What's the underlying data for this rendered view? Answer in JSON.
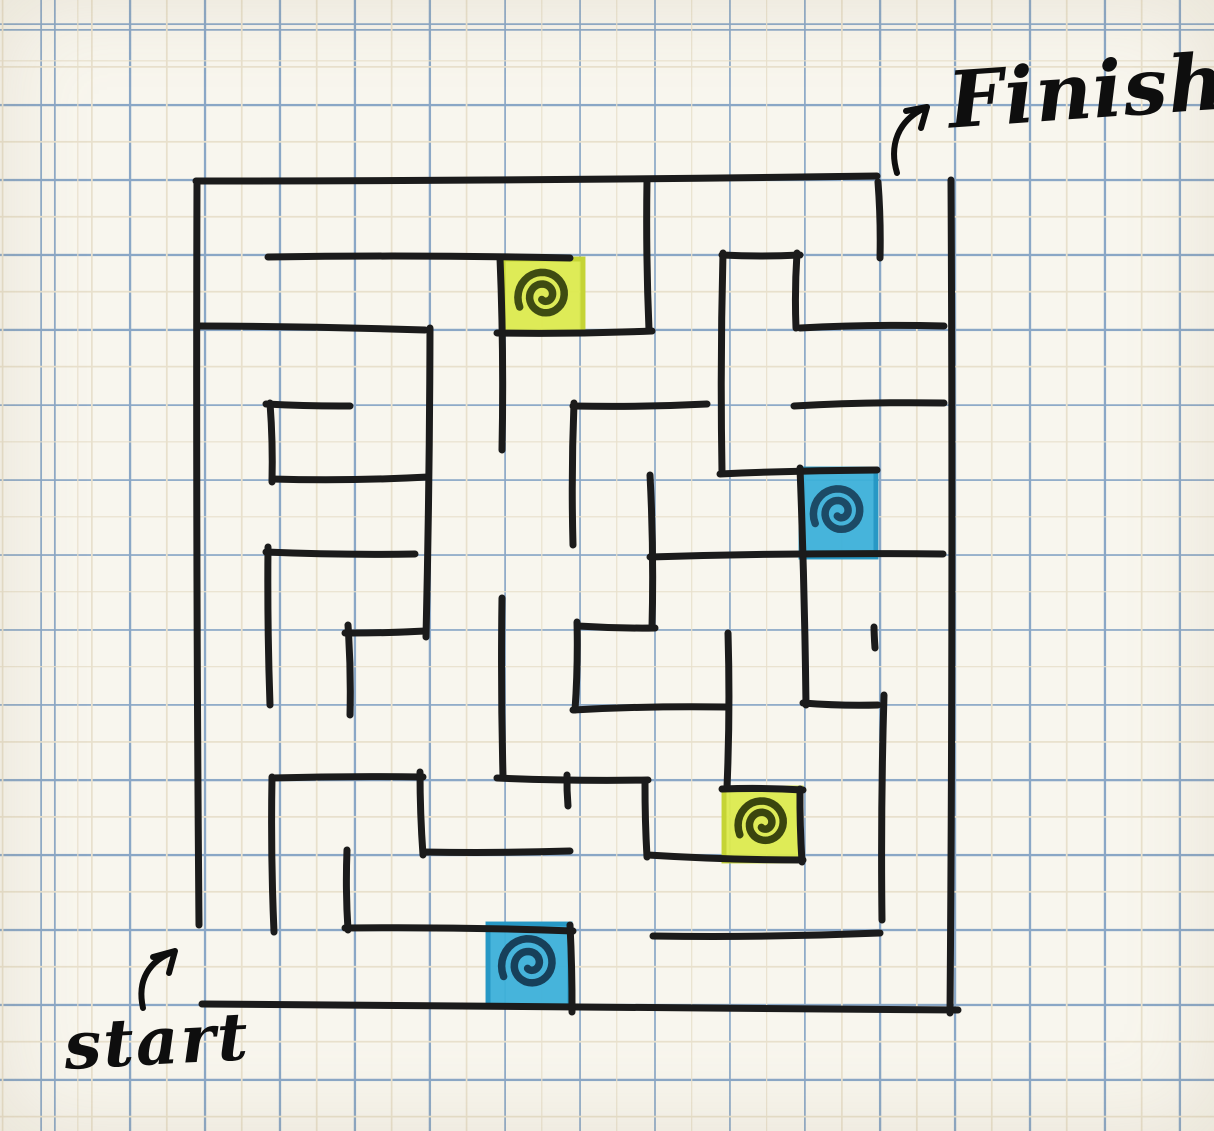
{
  "scene": {
    "description": "Hand-drawn maze puzzle on blue graph paper",
    "width": 1214,
    "height": 1131
  },
  "labels": {
    "finish": "Finish",
    "start": "start"
  },
  "colors": {
    "paper": "#f8f6ee",
    "grid_major": "#8aa7c6",
    "grid_minor": "#e8e0cc",
    "wall": "#1b1b1b",
    "ink": "#0e0e0e"
  },
  "grid": {
    "spacing": 75,
    "major_offset_x": 54,
    "major_offset_y": 29,
    "minor_offset_x": 91,
    "minor_offset_y": 66
  },
  "maze": {
    "cell_size": 75,
    "left": 200,
    "top": 180,
    "columns": 10,
    "rows": 11,
    "openings": {
      "start": "left edge of bottom row (bottom-left)",
      "finish": "top edge of rightmost column (top-right)"
    },
    "walls": [
      [
        196,
        181,
        877,
        176
      ],
      [
        268,
        257,
        570,
        258
      ],
      [
        722,
        255,
        800,
        255
      ],
      [
        199,
        326,
        425,
        330
      ],
      [
        497,
        333,
        652,
        331
      ],
      [
        800,
        328,
        944,
        326
      ],
      [
        266,
        404,
        350,
        406
      ],
      [
        573,
        406,
        707,
        404
      ],
      [
        794,
        406,
        944,
        403
      ],
      [
        272,
        479,
        428,
        477
      ],
      [
        720,
        474,
        877,
        470
      ],
      [
        266,
        552,
        415,
        554
      ],
      [
        650,
        557,
        943,
        554
      ],
      [
        345,
        633,
        425,
        631
      ],
      [
        578,
        626,
        655,
        628
      ],
      [
        573,
        710,
        727,
        707
      ],
      [
        803,
        703,
        878,
        705
      ],
      [
        272,
        778,
        423,
        777
      ],
      [
        497,
        778,
        648,
        780
      ],
      [
        722,
        789,
        803,
        790
      ],
      [
        423,
        852,
        570,
        851
      ],
      [
        648,
        855,
        803,
        860
      ],
      [
        345,
        928,
        573,
        931
      ],
      [
        653,
        936,
        880,
        933
      ],
      [
        202,
        1004,
        958,
        1010
      ],
      [
        197,
        181,
        199,
        925
      ],
      [
        270,
        403,
        272,
        482
      ],
      [
        268,
        547,
        270,
        705
      ],
      [
        272,
        777,
        274,
        932
      ],
      [
        348,
        625,
        350,
        715
      ],
      [
        347,
        850,
        348,
        930
      ],
      [
        430,
        328,
        426,
        637
      ],
      [
        420,
        772,
        423,
        855
      ],
      [
        500,
        258,
        502,
        450
      ],
      [
        502,
        598,
        503,
        776
      ],
      [
        574,
        403,
        573,
        545
      ],
      [
        577,
        622,
        575,
        710
      ],
      [
        567,
        775,
        568,
        806
      ],
      [
        570,
        925,
        572,
        1012
      ],
      [
        647,
        180,
        649,
        330
      ],
      [
        650,
        475,
        652,
        628
      ],
      [
        645,
        783,
        647,
        857
      ],
      [
        723,
        253,
        722,
        472
      ],
      [
        728,
        633,
        727,
        787
      ],
      [
        797,
        253,
        796,
        328
      ],
      [
        800,
        468,
        806,
        705
      ],
      [
        800,
        789,
        802,
        862
      ],
      [
        878,
        182,
        880,
        258
      ],
      [
        874,
        627,
        875,
        648
      ],
      [
        884,
        695,
        882,
        920
      ],
      [
        951,
        180,
        950,
        1013
      ]
    ]
  },
  "highlights": [
    {
      "name": "yellow-portal-top",
      "fill": "#dcea4e",
      "edge": "#c2d232",
      "spiral_color": "#3f4b12",
      "x": 501,
      "y": 257,
      "w": 84,
      "h": 79
    },
    {
      "name": "blue-portal-right",
      "fill": "#3cb0d9",
      "edge": "#2495c2",
      "spiral_color": "#1c4a66",
      "x": 799,
      "y": 467,
      "w": 79,
      "h": 92
    },
    {
      "name": "yellow-portal-lower",
      "fill": "#dcea4e",
      "edge": "#c2d232",
      "spiral_color": "#3a450e",
      "x": 722,
      "y": 786,
      "w": 81,
      "h": 77
    },
    {
      "name": "blue-portal-bottom",
      "fill": "#3cb0d9",
      "edge": "#2495c2",
      "spiral_color": "#17405a",
      "x": 486,
      "y": 922,
      "w": 86,
      "h": 86
    }
  ],
  "icons": {
    "finish_arrow": "M897,173 C889,146 897,120 927,107 M927,107 L906,111 M927,107 L921,128",
    "start_arrow": "M143,1008 C137,981 148,961 175,951 M175,951 L153,957 M175,951 L169,973"
  }
}
